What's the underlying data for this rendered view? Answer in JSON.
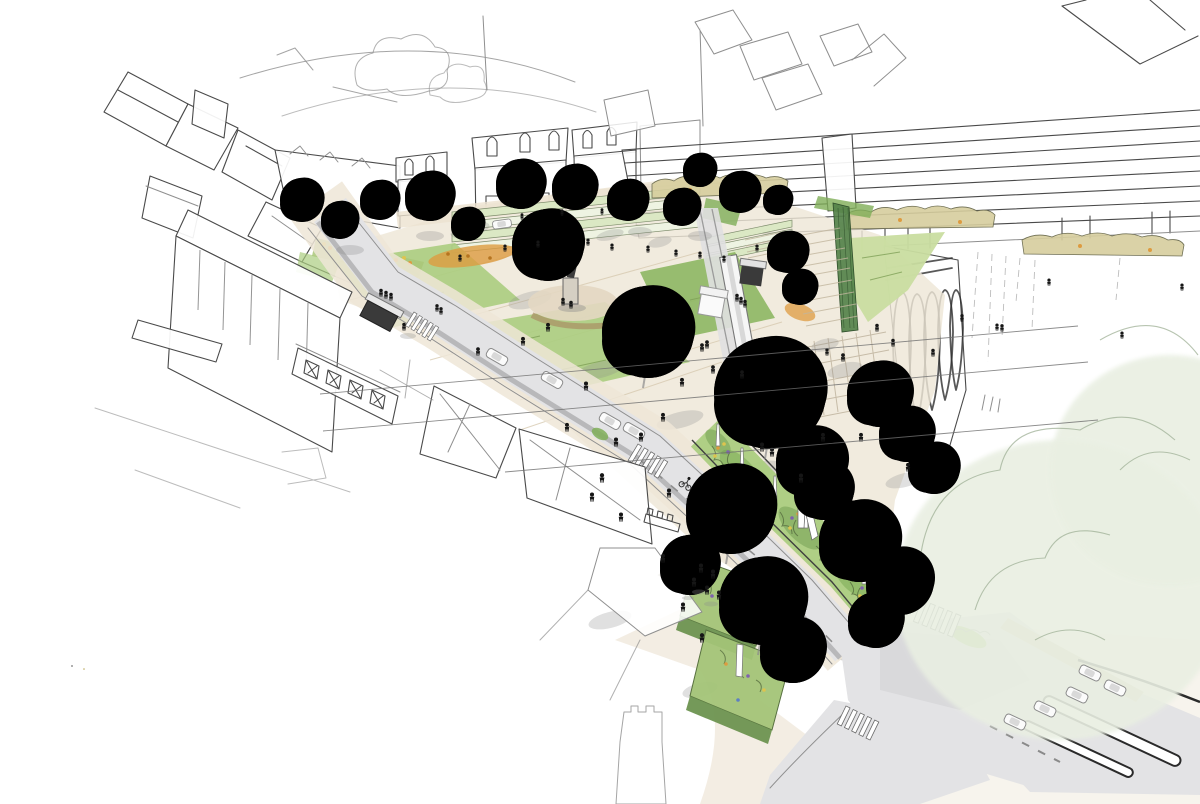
{
  "image": {
    "kind": "hand-drawn architectural concept sketch",
    "subject": "Aerial perspective sketch of a town-centre masterplan: a paved civic square with lawns, terraced seating and a statue, a tram running on a segregated track, a tree-lined diagonal street, linear wildflower rain gardens, clipped hedge blocks and a road junction with crossings and refuge islands, surrounded by outline-sketched townscape",
    "medium": "pencil line work with watercolour-style green washes",
    "visible_text": "none"
  },
  "palette": {
    "paper": "#ffffff",
    "ink": "#4a4a4a",
    "inkLight": "#8f8f8f",
    "inkDark": "#2e2e2e",
    "road": "#e3e3e5",
    "roadKerb": "#b3b3b5",
    "pavement": "#eee6d7",
    "pavementWarm": "#ddd0b4",
    "pavingLine": "#d5c7ad",
    "lawnBright": "#c9dda0",
    "lawnMid": "#abcd80",
    "lawnDark": "#8db763",
    "treeMid": "#9cc377",
    "treeDark": "#6f9b50",
    "treePale": "#c9dfae",
    "treeWash": "#dce9cc",
    "cloudWash": "#e9efe2",
    "shrub": "#7fae58",
    "flowerOrange": "#dd9b40",
    "flowerYellow": "#ddc44e",
    "flowerPurple": "#7f63ad",
    "autumnHedge": "#d6cd9d",
    "fence": "#55824a",
    "figure": "#161616",
    "tramBody": "#f6f6f6",
    "tramFront": "#2e2e2e",
    "shadow": "#8a8a8a"
  },
  "scene": {
    "background": {
      "label": "outline rooftops and tree clouds of the surrounding townscape"
    },
    "mansard_terrace": {
      "label": "terrace of mansard-roofed buildings with arched dormers"
    },
    "ribbon_building": {
      "label": "long modern building drawn as horizontal glazing bands",
      "glazing_bands": 8
    },
    "white_forecourt": {
      "label": "open white forecourt with faint hatching and sparse figures"
    },
    "arcade_sketch": {
      "label": "heavily scribbled arcaded building corner"
    },
    "civic_square": {
      "label": "paved civic square with lawns, flower beds and terraced seating",
      "lawns": 4,
      "terrace_rows": 4
    },
    "statue": {
      "label": "statue on a stone plinth at the heart of the square"
    },
    "tram_corridor": {
      "label": "tram on segregated track with overhead wires",
      "wires": 3,
      "shelters": 2,
      "kiosks": 1
    },
    "main_street": {
      "label": "diagonal tree-lined street",
      "cars": 5,
      "zebra_crossings": 2,
      "cyclists": 1,
      "bus_shelters": 1
    },
    "junction": {
      "label": "road junction",
      "cars": 5,
      "zebra_crossings": 2,
      "refuge_islands": 2
    },
    "rain_garden": {
      "label": "linear wildflower rain garden with white bollards",
      "bollards": 6
    },
    "hedge_blocks": {
      "label": "clipped hedge blocks with flower speckles",
      "count": 2
    },
    "flower_beds": {
      "label": "ornamental wildflower beds",
      "count": 4
    },
    "street_trees": {
      "label": "round-crowned street trees",
      "count": 14
    },
    "park_trees": {
      "label": "soft watercolour park canopies",
      "count": 15
    },
    "large_park_trees": {
      "label": "large pale cloud-washed park trees",
      "count": 2
    },
    "green_fence": {
      "label": "dark green fence / hedge screen beside the lawn"
    },
    "people": {
      "label": "small black pedestrian figures",
      "count": 64
    },
    "foreground_buildings": {
      "label": "outline-sketched foreground rooftops and white civic building"
    }
  }
}
